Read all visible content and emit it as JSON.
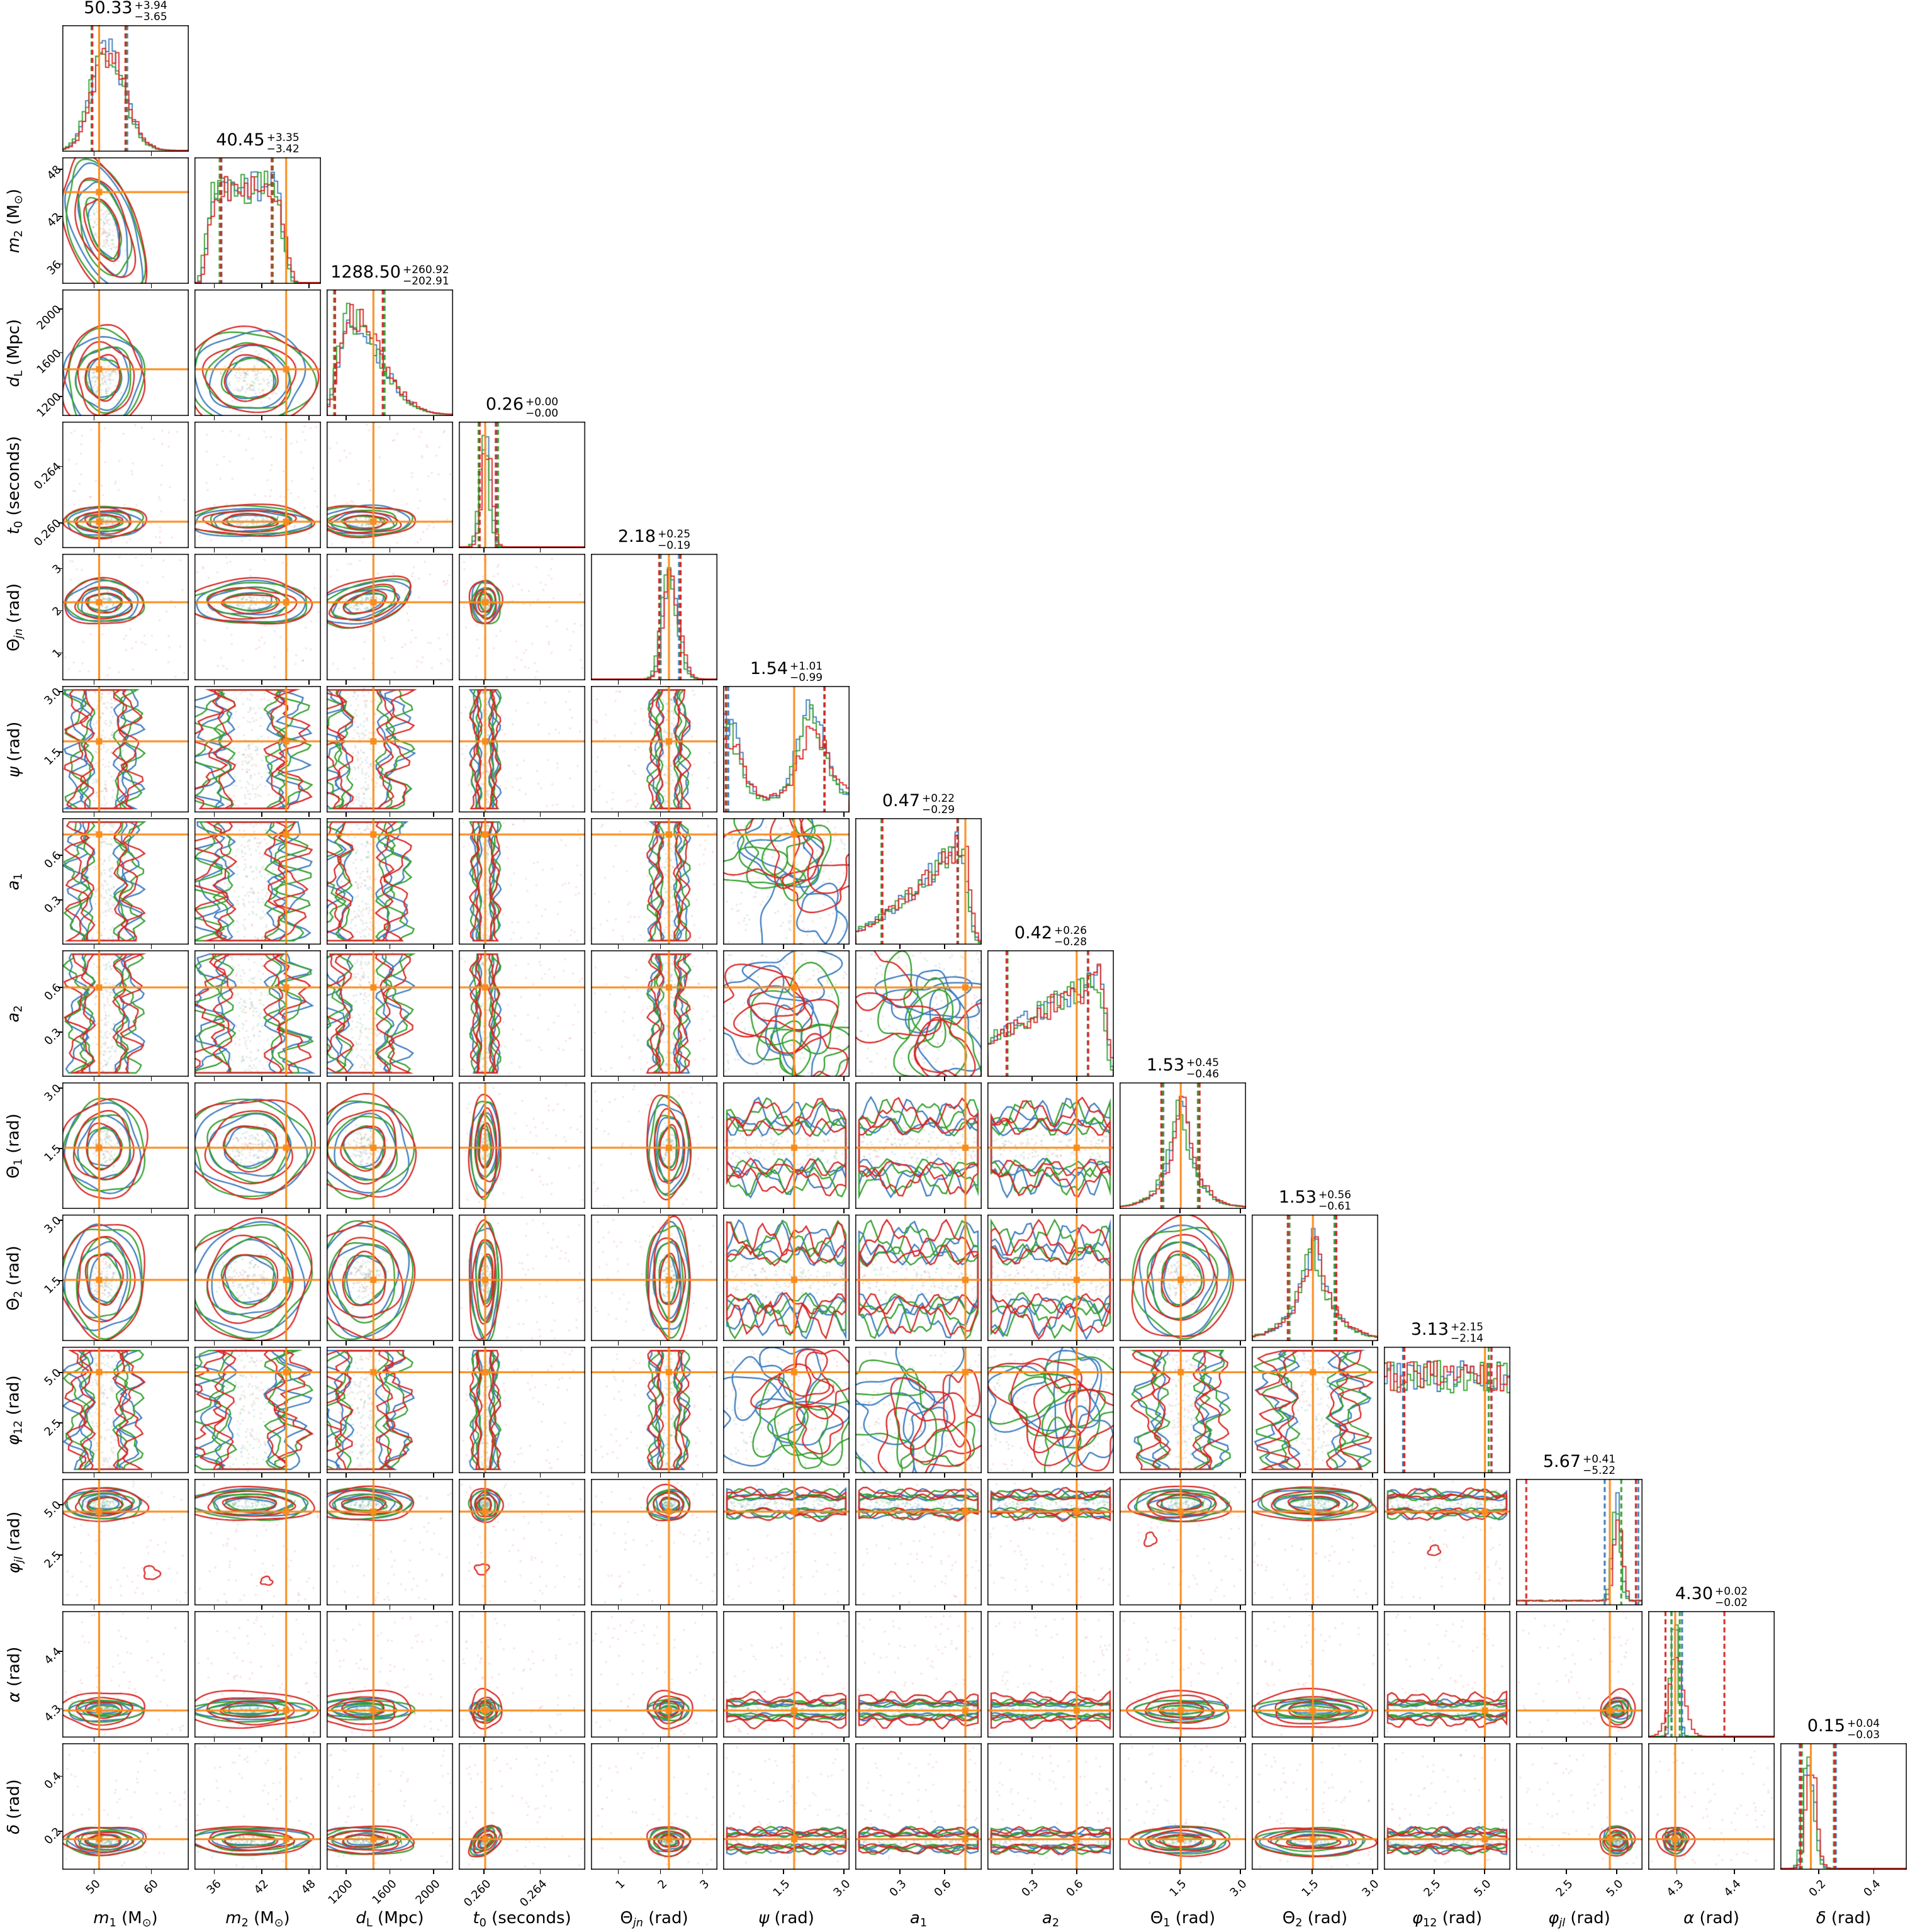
{
  "figure": {
    "background": "#ffffff"
  },
  "colors": {
    "series": [
      "#d92523",
      "#3b7bbf",
      "#33a02c"
    ],
    "truth": "#fa8c1b",
    "axis": "#000000"
  },
  "chart_data": {
    "type": "corner",
    "n_params": 14,
    "legend": "none",
    "grid": false,
    "contour_series_colors": [
      "#d92523",
      "#3b7bbf",
      "#33a02c"
    ],
    "truth_color": "#fa8c1b",
    "correlations": {
      "1-0": -0.55,
      "4-2": 0.5,
      "13-3": 0.55
    },
    "parameters": [
      {
        "key": "m1",
        "label_parts": [
          [
            "m",
            "i"
          ],
          [
            "1",
            "s"
          ],
          [
            " (M",
            ""
          ],
          [
            "⊙",
            "s"
          ],
          [
            ")",
            ""
          ]
        ],
        "title": {
          "median": "50.33",
          "plus": "+3.94",
          "minus": "−3.65"
        },
        "range": [
          44.5,
          66.5
        ],
        "truth": 50.9,
        "ticks": [
          {
            "label": "50",
            "value": 50
          },
          {
            "label": "60",
            "value": 60
          }
        ],
        "hist": {
          "type": "gauss",
          "mu": 0.345,
          "sig": 0.115,
          "skew": 0.25
        },
        "dim2": {
          "kind": "peaked",
          "c": 0.33,
          "w": 0.13
        },
        "q": [
          0.235,
          0.51
        ],
        "red_wide": false
      },
      {
        "key": "m2",
        "label_parts": [
          [
            "m",
            "i"
          ],
          [
            "2",
            "s"
          ],
          [
            " (M",
            ""
          ],
          [
            "⊙",
            "s"
          ],
          [
            ")",
            ""
          ]
        ],
        "title": {
          "median": "40.45",
          "plus": "+3.35",
          "minus": "−3.42"
        },
        "range": [
          33.5,
          49.5
        ],
        "truth": 45.1,
        "ticks": [
          {
            "label": "36",
            "value": 36
          },
          {
            "label": "42",
            "value": 42
          },
          {
            "label": "48",
            "value": 48
          }
        ],
        "hist": {
          "type": "plateau",
          "a": 0.1,
          "b": 0.62,
          "edge": 0.14
        },
        "dim2": {
          "kind": "peaked",
          "c": 0.44,
          "w": 0.2
        },
        "q": [
          0.21,
          0.615
        ],
        "red_wide": false
      },
      {
        "key": "dL",
        "label_parts": [
          [
            "d",
            "i"
          ],
          [
            "L",
            "s"
          ],
          [
            " (Mpc)",
            ""
          ]
        ],
        "title": {
          "median": "1288.50",
          "plus": "+260.92",
          "minus": "−202.91"
        },
        "range": [
          1020,
          2180
        ],
        "truth": 1449,
        "ticks": [
          {
            "label": "1200",
            "value": 1200
          },
          {
            "label": "1600",
            "value": 1600
          },
          {
            "label": "2000",
            "value": 2000
          }
        ],
        "hist": {
          "type": "skew",
          "mu": 0.185,
          "sig": 0.085,
          "tail": 2.8
        },
        "dim2": {
          "kind": "peaked",
          "c": 0.3,
          "w": 0.16
        },
        "q": [
          0.07,
          0.45
        ],
        "red_wide": false
      },
      {
        "key": "t0",
        "label_parts": [
          [
            "t",
            "i"
          ],
          [
            "0",
            "s"
          ],
          [
            " (seconds)",
            ""
          ]
        ],
        "title": {
          "median": "0.26",
          "plus": "+0.00",
          "minus": "−0.00"
        },
        "range": [
          0.2582,
          0.2672
        ],
        "truth": 0.26008,
        "ticks": [
          {
            "label": "0.260",
            "value": 0.26
          },
          {
            "label": "0.264",
            "value": 0.264
          }
        ],
        "hist": {
          "type": "gauss",
          "mu": 0.21,
          "sig": 0.038
        },
        "dim2": {
          "kind": "peaked",
          "c": 0.21,
          "w": 0.05
        },
        "q": [
          0.155,
          0.3
        ],
        "red_wide": true
      },
      {
        "key": "theta_jn",
        "label_parts": [
          [
            "Θ",
            ""
          ],
          [
            "jn",
            "si"
          ],
          [
            " (rad)",
            ""
          ]
        ],
        "title": {
          "median": "2.18",
          "plus": "+0.25",
          "minus": "−0.19"
        },
        "range": [
          0.35,
          3.35
        ],
        "truth": 2.2,
        "ticks": [
          {
            "label": "1",
            "value": 1
          },
          {
            "label": "2",
            "value": 2
          },
          {
            "label": "3",
            "value": 3
          }
        ],
        "hist": {
          "type": "gauss",
          "mu": 0.615,
          "sig": 0.05,
          "skew": 0.4
        },
        "dim2": {
          "kind": "peaked",
          "c": 0.615,
          "w": 0.07
        },
        "q": [
          0.55,
          0.7
        ],
        "red_wide": true
      },
      {
        "key": "psi",
        "label_parts": [
          [
            "ψ",
            "i"
          ],
          [
            " (rad)",
            ""
          ]
        ],
        "title": {
          "median": "1.54",
          "plus": "+1.01",
          "minus": "−0.99"
        },
        "range": [
          0,
          3.1416
        ],
        "truth": 1.765,
        "ticks": [
          {
            "label": "1.5",
            "value": 1.5
          },
          {
            "label": "3.0",
            "value": 3.0
          }
        ],
        "hist": {
          "type": "bimodal",
          "mu1": 0.04,
          "mu2": 0.7,
          "sig": 0.1,
          "base": 0.22,
          "w1": [
            0.62,
            0.8,
            0.75
          ],
          "w2": [
            0.66,
            1.0,
            0.85
          ]
        },
        "dim2": {
          "kind": "band",
          "c": 0.45,
          "w": 0.42
        },
        "q": [
          0.03,
          0.8
        ],
        "red_wide": false
      },
      {
        "key": "a1",
        "label_parts": [
          [
            "a",
            "i"
          ],
          [
            "1",
            "s"
          ]
        ],
        "title": {
          "median": "0.47",
          "plus": "+0.22",
          "minus": "−0.29"
        },
        "range": [
          0,
          0.85
        ],
        "truth": 0.74,
        "ticks": [
          {
            "label": "0.3",
            "value": 0.3
          },
          {
            "label": "0.6",
            "value": 0.6
          }
        ],
        "hist": {
          "type": "rise",
          "cut": 0.84,
          "f0": 0.12,
          "p": 1.3
        },
        "dim2": {
          "kind": "band",
          "c": 0.52,
          "w": 0.4
        },
        "q": [
          0.21,
          0.815
        ],
        "red_wide": false
      },
      {
        "key": "a2",
        "label_parts": [
          [
            "a",
            "i"
          ],
          [
            "2",
            "s"
          ]
        ],
        "title": {
          "median": "0.42",
          "plus": "+0.26",
          "minus": "−0.28"
        },
        "range": [
          0,
          0.85
        ],
        "truth": 0.6,
        "ticks": [
          {
            "label": "0.3",
            "value": 0.3
          },
          {
            "label": "0.6",
            "value": 0.6
          }
        ],
        "hist": {
          "type": "rise",
          "cut": 0.88,
          "f0": 0.35,
          "p": 1.0
        },
        "dim2": {
          "kind": "band",
          "c": 0.5,
          "w": 0.42
        },
        "q": [
          0.16,
          0.79
        ],
        "red_wide": false
      },
      {
        "key": "theta1",
        "label_parts": [
          [
            "Θ",
            ""
          ],
          [
            "1",
            "s"
          ],
          [
            " (rad)",
            ""
          ]
        ],
        "title": {
          "median": "1.53",
          "plus": "+0.45",
          "minus": "−0.46"
        },
        "range": [
          0,
          3.1416
        ],
        "truth": 1.52,
        "ticks": [
          {
            "label": "1.5",
            "value": 1.5
          },
          {
            "label": "3.0",
            "value": 3.0
          }
        ],
        "hist": {
          "type": "laplace",
          "mu": 0.487,
          "b": 0.105
        },
        "dim2": {
          "kind": "peaked",
          "c": 0.487,
          "w": 0.16
        },
        "q": [
          0.34,
          0.63
        ],
        "red_wide": false
      },
      {
        "key": "theta2",
        "label_parts": [
          [
            "Θ",
            ""
          ],
          [
            "2",
            "s"
          ],
          [
            " (rad)",
            ""
          ]
        ],
        "title": {
          "median": "1.53",
          "plus": "+0.56",
          "minus": "−0.61"
        },
        "range": [
          0,
          3.1416
        ],
        "truth": 1.52,
        "ticks": [
          {
            "label": "1.5",
            "value": 1.5
          },
          {
            "label": "3.0",
            "value": 3.0
          }
        ],
        "hist": {
          "type": "laplace",
          "mu": 0.487,
          "b": 0.14
        },
        "dim2": {
          "kind": "peaked",
          "c": 0.487,
          "w": 0.19
        },
        "q": [
          0.29,
          0.66
        ],
        "red_wide": false
      },
      {
        "key": "phi12",
        "label_parts": [
          [
            "φ",
            "i"
          ],
          [
            "12",
            "s"
          ],
          [
            " (rad)",
            ""
          ]
        ],
        "title": {
          "median": "3.13",
          "plus": "+2.15",
          "minus": "−2.14"
        },
        "range": [
          0,
          6.2832
        ],
        "truth": 5.02,
        "ticks": [
          {
            "label": "2.5",
            "value": 2.5
          },
          {
            "label": "5.0",
            "value": 5.0
          }
        ],
        "hist": {
          "type": "flat"
        },
        "dim2": {
          "kind": "band",
          "c": 0.5,
          "w": 0.43
        },
        "q": [
          0.16,
          0.84
        ],
        "red_wide": false
      },
      {
        "key": "phi_jl",
        "label_parts": [
          [
            "φ",
            "i"
          ],
          [
            "jl",
            "si"
          ],
          [
            " (rad)",
            ""
          ]
        ],
        "title": {
          "median": "5.67",
          "plus": "+0.41",
          "minus": "−5.22"
        },
        "range": [
          0,
          6.2832
        ],
        "truth": 4.66,
        "ticks": [
          {
            "label": "2.5",
            "value": 2.5
          },
          {
            "label": "5.0",
            "value": 5.0
          }
        ],
        "hist": {
          "type": "spike",
          "mu": 0.8,
          "sig": 0.032,
          "base": 0.035
        },
        "dim2": {
          "kind": "peaked",
          "c": 0.8,
          "w": 0.05,
          "red_w": 0.055
        },
        "q": [
          0.07,
          0.955
        ],
        "q3": [
          [
            0.07,
            0.955
          ],
          [
            0.7,
            0.96
          ],
          [
            0.835,
            0.945
          ]
        ],
        "red_wide": true
      },
      {
        "key": "alpha",
        "label_parts": [
          [
            "α",
            "i"
          ],
          [
            " (rad)",
            ""
          ]
        ],
        "title": {
          "median": "4.30",
          "plus": "+0.02",
          "minus": "−0.02"
        },
        "range": [
          4.25,
          4.47
        ],
        "truth": 4.297,
        "ticks": [
          {
            "label": "4.3",
            "value": 4.3
          },
          {
            "label": "4.4",
            "value": 4.4
          }
        ],
        "hist": {
          "type": "gauss",
          "mu": 0.218,
          "sig": 0.026,
          "red_sig": 0.06
        },
        "dim2": {
          "kind": "peaked",
          "c": 0.218,
          "w": 0.035,
          "red_w": 0.06
        },
        "q": [
          0.18,
          0.26
        ],
        "q3": [
          [
            0.13,
            0.6
          ],
          [
            0.18,
            0.26
          ],
          [
            0.19,
            0.245
          ]
        ],
        "red_wide": true
      },
      {
        "key": "delta",
        "label_parts": [
          [
            "δ",
            "i"
          ],
          [
            " (rad)",
            ""
          ]
        ],
        "title": {
          "median": "0.15",
          "plus": "+0.04",
          "minus": "−0.03"
        },
        "range": [
          0.06,
          0.52
        ],
        "truth": 0.171,
        "ticks": [
          {
            "label": "0.2",
            "value": 0.2
          },
          {
            "label": "0.4",
            "value": 0.4
          }
        ],
        "hist": {
          "type": "gauss",
          "mu": 0.225,
          "sig": 0.035,
          "skew": 0.3
        },
        "dim2": {
          "kind": "peaked",
          "c": 0.23,
          "w": 0.045
        },
        "q": [
          0.16,
          0.43
        ],
        "red_wide": true
      }
    ]
  }
}
